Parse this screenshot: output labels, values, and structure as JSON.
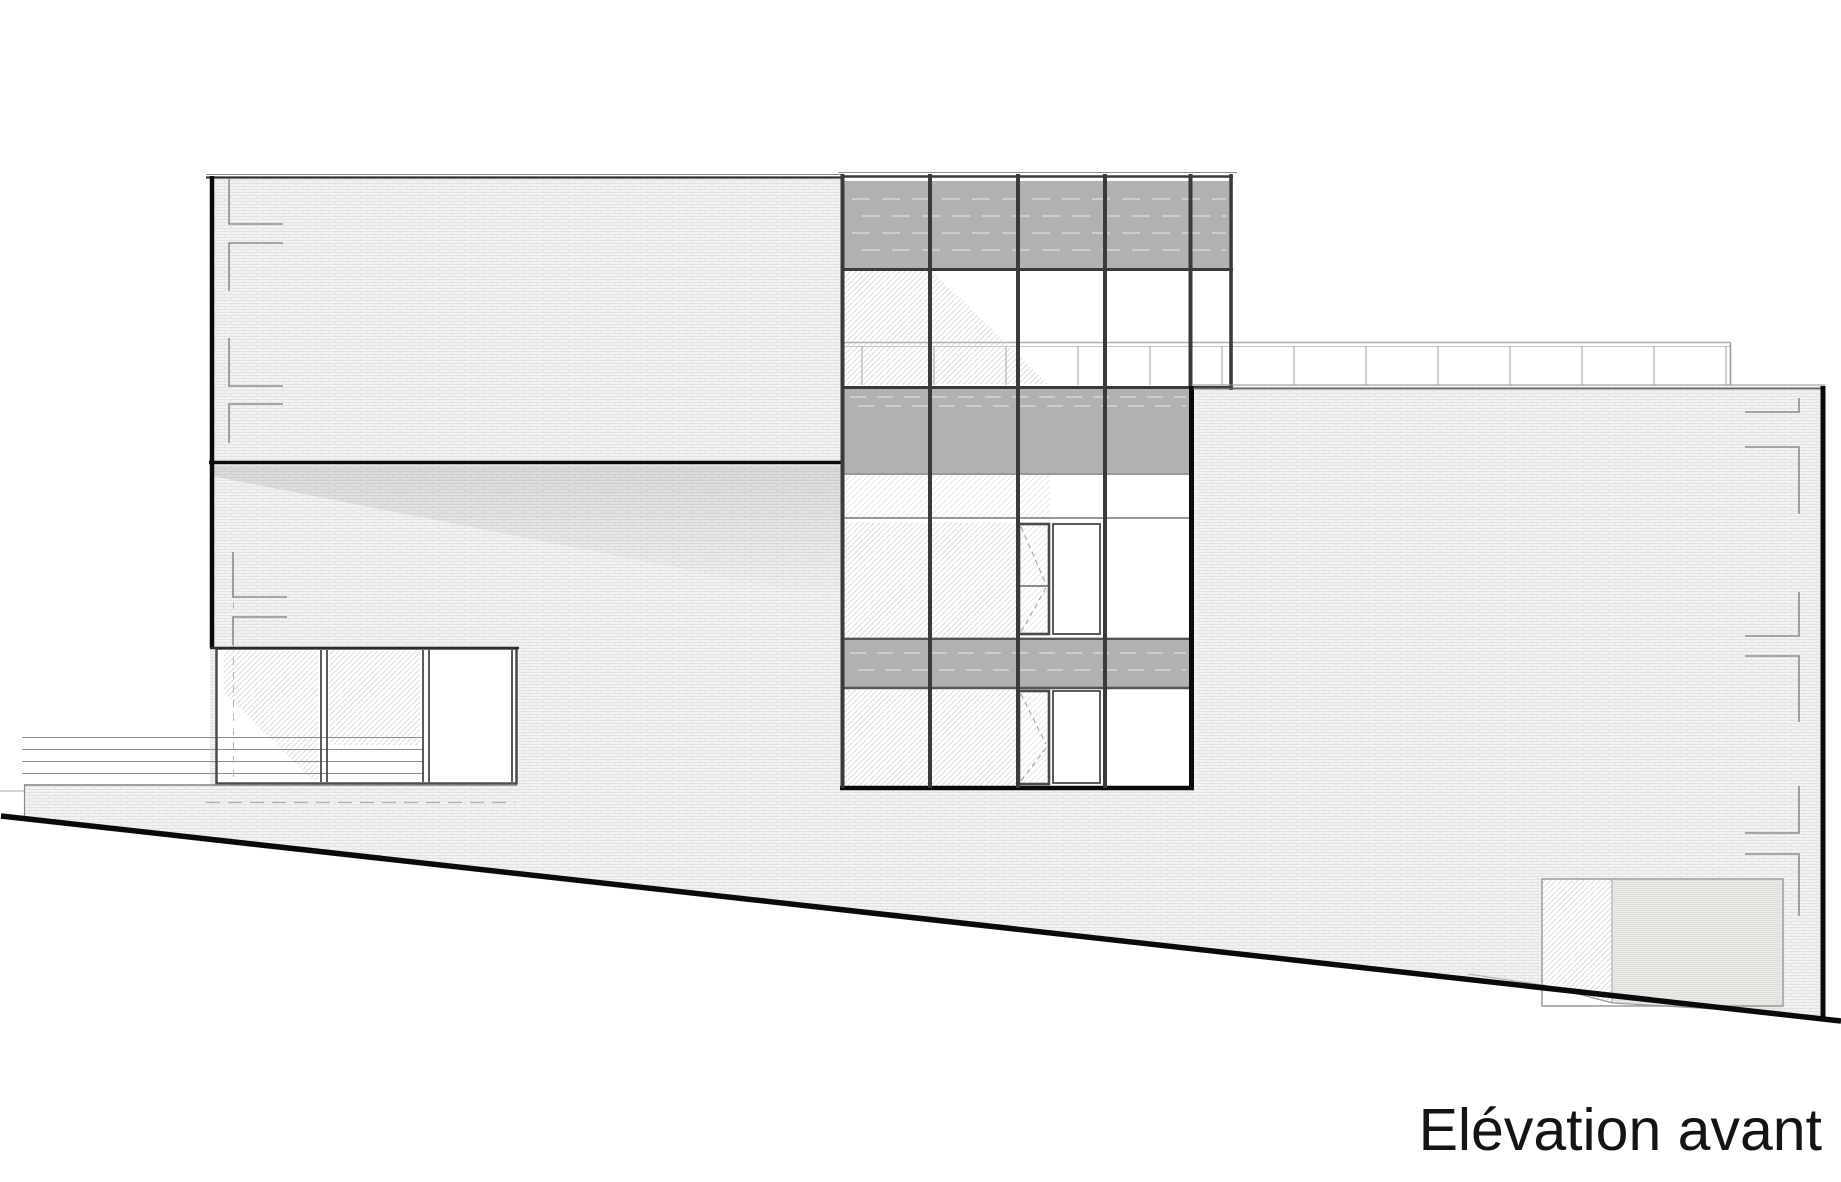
{
  "sheet": {
    "title": "Elévation avant"
  },
  "colors": {
    "line": "#0a0a0a",
    "mullion": "#3a3a3a",
    "frame": "#4a4a4a",
    "spandrel": "#b1b1b1",
    "spandrel_dash": "#cdcdcd",
    "brick_bg": "#f2f2f1",
    "brick_line": "#e3e3e1",
    "hatch_line": "#d6d6d6",
    "railing": "#b0b0b0",
    "thin_line": "#8c8c8c",
    "title_text": "#141414"
  }
}
